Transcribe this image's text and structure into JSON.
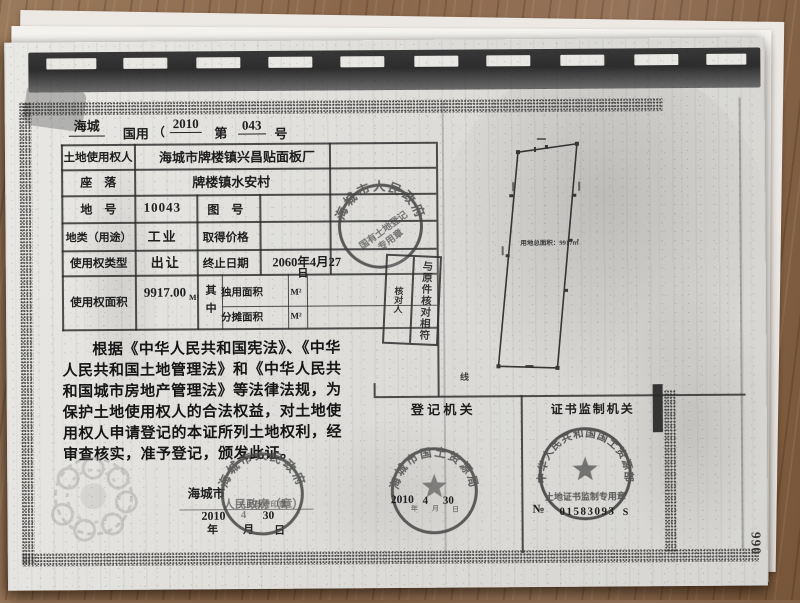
{
  "page": {
    "header": {
      "region": "海城",
      "type_label": "国用",
      "open": "（",
      "year": "2010",
      "no_label": "第",
      "serial": "043",
      "unit": "号"
    },
    "table": {
      "r1_label": "土地使用权人",
      "r1_value": "海城市牌楼镇兴昌贴面板厂",
      "r2_label": "座　落",
      "r2_value": "牌楼镇水安村",
      "r3_label": "地　号",
      "r3_value": "10043",
      "r3_label2": "图　号",
      "r4_label": "地类（用途）",
      "r4_value": "工业",
      "r4_label2": "取得价格",
      "r5_label": "使用权类型",
      "r5_value": "出让",
      "r5_label2": "终止日期",
      "r5_value2": "2060年4月27",
      "r5_value2_tail": "日",
      "r6_label": "使用权面积",
      "r6_value": "9917.00",
      "r6_unit": "M²",
      "r6_mid": "其中",
      "r6a_label": "独用面积",
      "r6a_unit": "M²",
      "r6b_label": "分摊面积",
      "r6b_unit": "M²"
    },
    "legal": {
      "lines": [
        "根据《中华人民共和国宪法》、《中华",
        "人民共和国土地管理法》和《中华人民共",
        "和国城市房地产管理法》等法律法规，为",
        "保护土地使用权人的合法权益，对土地使",
        "用权人申请登记的本证所列土地权利，经",
        "审查核实，准予登记，颁发此证。"
      ]
    },
    "issuer": {
      "org": "海城市",
      "org_rest": "人民政府（章）",
      "year": "2010",
      "year_char": "年",
      "month": "4",
      "month_char": "月",
      "day": "30",
      "day_char": "日"
    },
    "sections": {
      "registry": "登 记 机 关",
      "supervisor": "证书监制机关"
    },
    "plot": {
      "area_text": "用地总面积：9917㎡",
      "marker": "线"
    },
    "seals": {
      "table_seal": {
        "ring": "海城市人民政府",
        "line1": "国有土地登记",
        "line2": "专用章"
      },
      "verify": {
        "main": "与原件核对相符",
        "sub": "核对人"
      },
      "gov": {
        "ring": "海城市人民政府",
        "inner": "人民政府印章"
      },
      "bureau": {
        "ring": "海城市国土资源局",
        "year": "2010",
        "month": "4",
        "day": "30",
        "y_char": "年",
        "m_char": "月",
        "d_char": "日"
      },
      "ministry": {
        "ring": "中华人民共和国国土资源部",
        "banner": "土地证书监制专用章",
        "no_prefix": "№",
        "no_value": "01583093",
        "no_suffix": "S"
      }
    },
    "page_number": "990"
  }
}
